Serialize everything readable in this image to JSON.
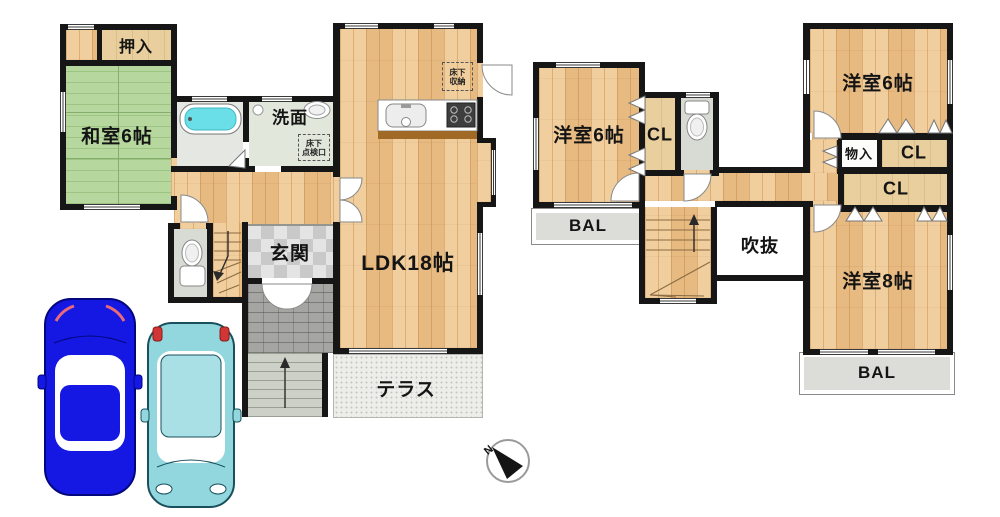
{
  "floor1": {
    "oshiire": "押入",
    "washitsu": "和室6帖",
    "senmen": "洗面",
    "genkan": "玄関",
    "ldk": "LDK18帖",
    "terrace": "テラス",
    "underfloor_hatch": {
      "line1": "床下",
      "line2": "点検口"
    },
    "underfloor_storage": {
      "line1": "床下",
      "line2": "収納"
    }
  },
  "floor2": {
    "bedroom6_left": "洋室6帖",
    "bedroom6_right": "洋室6帖",
    "bedroom8": "洋室8帖",
    "closet": "CL",
    "storage": "物入",
    "void": "吹抜",
    "balcony": "BAL"
  },
  "compass": {
    "north": "N"
  },
  "colors": {
    "wall": "#161616",
    "wood_floor": "#ecc28c",
    "tatami": "#b6d89e",
    "closet_tan": "#e9cf9e",
    "bathtub_water": "#6adfe7",
    "balcony_gray": "#dcdcd8",
    "car_blue": "#1517e2",
    "car_teal": "#92d7de"
  }
}
